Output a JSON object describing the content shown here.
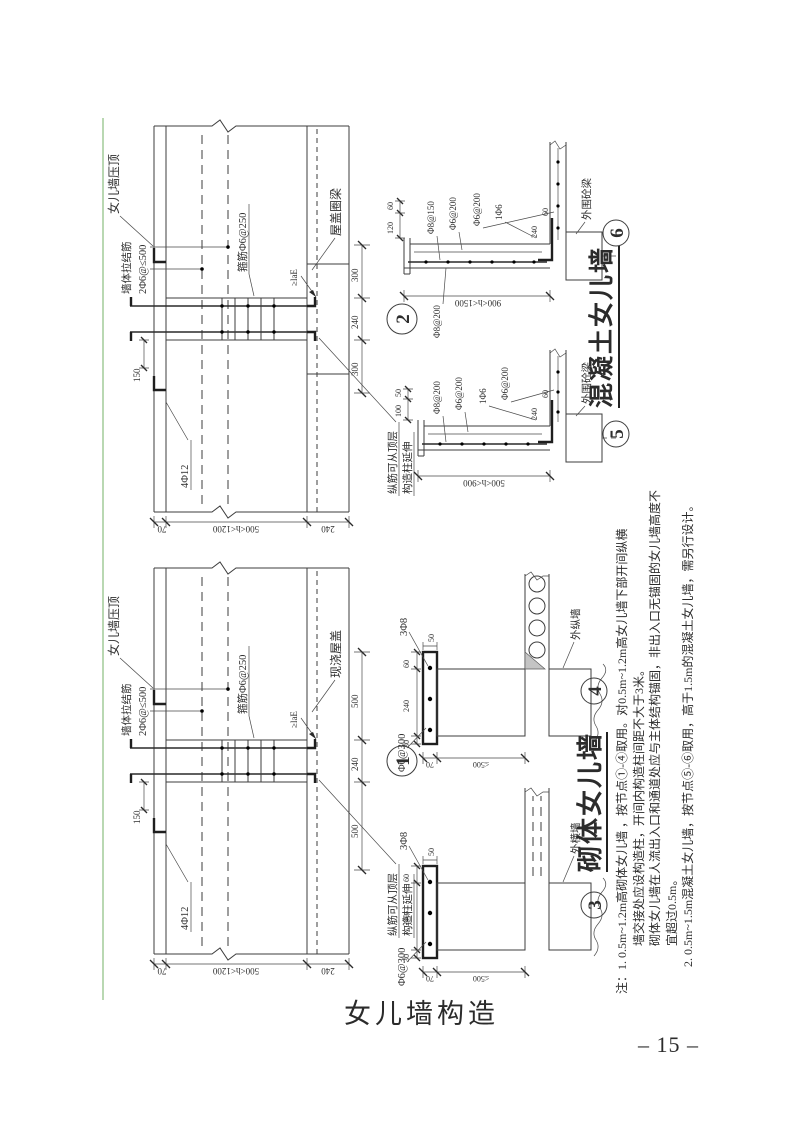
{
  "page": {
    "caption": "女儿墙构造",
    "page_number": "– 15 –"
  },
  "colors": {
    "edge_line": "#b9d8b2",
    "ink": "#2e2e2e"
  },
  "headings": {
    "masonry": "砌体女儿墙",
    "concrete": "混凝土女儿墙"
  },
  "notes": {
    "prefix": "注：",
    "lines": [
      "1. 0.5m~1.2m高砌体女儿墙 ，按节点①-④取用。对0.5m~1.2m高女儿墙下部开间纵横",
      "墙交接处应设构造柱，开间内构造柱间距不大于3米。",
      "砌体女儿墙在人流出入口和通道处应与主体结构锚固，非出入口无锚固的女儿墙高度不",
      "宜超过0.5m。",
      "2. 0.5m~1.5m混凝土女儿墙，按节点⑤-⑥取用，高于1.5m的混凝土女儿墙，需另行设计。"
    ]
  },
  "details": {
    "d1": {
      "number": "1",
      "coping": "女儿墙压顶",
      "tie1": "墙体拉结筋",
      "tie2": "2Φ6@≤500",
      "roof": "现浇屋盖",
      "stirrup": "箍筋Φ6@250",
      "bars": "4Φ12",
      "anchor": "≥laE",
      "ext1": "纵筋可从顶层",
      "ext2": "构造柱延伸",
      "hook_dim": "150",
      "left_dims": [
        "70",
        "500<h<1200",
        "240"
      ],
      "segs": [
        "500",
        "240",
        "500"
      ]
    },
    "d2": {
      "number": "2",
      "coping": "女儿墙压顶",
      "tie1": "墙体拉结筋",
      "tie2": "2Φ6@≤500",
      "roof": "屋盖圈梁",
      "stirrup": "箍筋Φ6@250",
      "bars": "4Φ12",
      "anchor": "≥laE",
      "ext1": "纵筋可从顶层",
      "ext2": "构造柱延伸",
      "hook_dim": "150",
      "left_dims": [
        "70",
        "500<h<1200",
        "240"
      ],
      "segs": [
        "300",
        "240",
        "300"
      ]
    },
    "d3": {
      "number": "3",
      "mesh": "Φ6@300",
      "bars": "3Φ8",
      "cap_dims": [
        "30",
        "240",
        "60"
      ],
      "cap_edge": "50",
      "left_dims": [
        "70",
        "≤500"
      ],
      "wall": "外横墙"
    },
    "d4": {
      "number": "4",
      "mesh": "Φ6@300",
      "bars": "3Φ8",
      "cap_dims": [
        "30",
        "240",
        "60"
      ],
      "cap_edge": "50",
      "left_dims": [
        "70",
        "≤500"
      ],
      "wall": "外纵墙"
    },
    "d5": {
      "number": "5",
      "rebar": [
        "Φ8@200",
        "Φ6@200",
        "1Φ6",
        "Φ6@200"
      ],
      "cap_dims": [
        "100",
        "50"
      ],
      "bend_dims": [
        "240",
        "60"
      ],
      "height": "500<h<900",
      "beam": "外围砼梁"
    },
    "d6": {
      "number": "6",
      "rebar": [
        "Φ8@150",
        "Φ6@200",
        "Φ6@200",
        "1Φ6"
      ],
      "wall_rebar": "Φ8@200",
      "cap_dims": [
        "120",
        "60"
      ],
      "bend_dims": [
        "240",
        "60"
      ],
      "height": "900<h<1500",
      "beam": "外围砼梁"
    }
  }
}
